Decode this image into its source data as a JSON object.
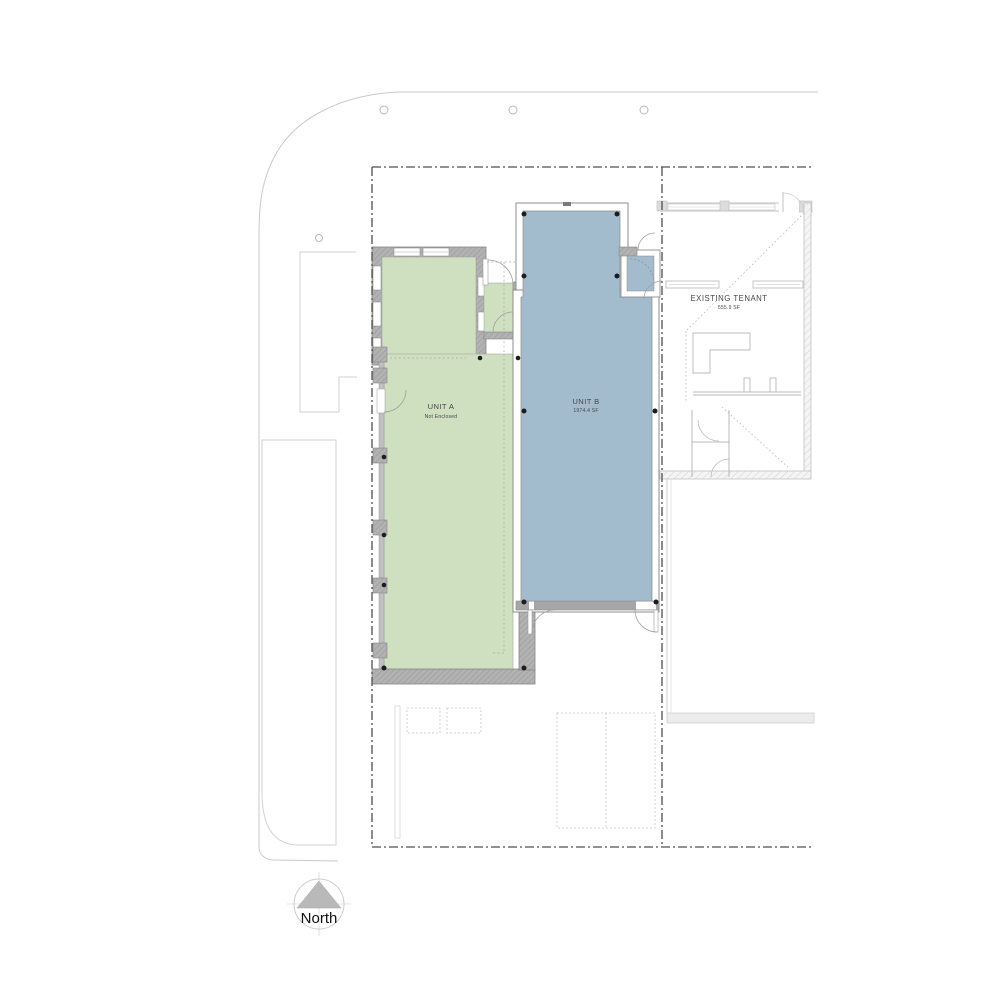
{
  "plan": {
    "unit_a": {
      "title": "UNIT A",
      "subtitle": "Not Enclosed"
    },
    "unit_b": {
      "title": "UNIT B",
      "subtitle": "1974.4 SF"
    },
    "existing_tenant": {
      "title": "EXISTING TENANT",
      "subtitle": "555.9 SF"
    },
    "north_arrow": {
      "label": "North"
    }
  },
  "colors": {
    "unit_a_fill": "#cfe0c0",
    "unit_b_fill": "#a3bccd",
    "wall_gray": "#b2b2b2",
    "wall_dark": "#a6a6a6",
    "site_line": "#c9c9c9",
    "lease_line": "#4f4f4f",
    "tenant_line": "#c2c2c2",
    "column_dot": "#1d1d1d"
  }
}
